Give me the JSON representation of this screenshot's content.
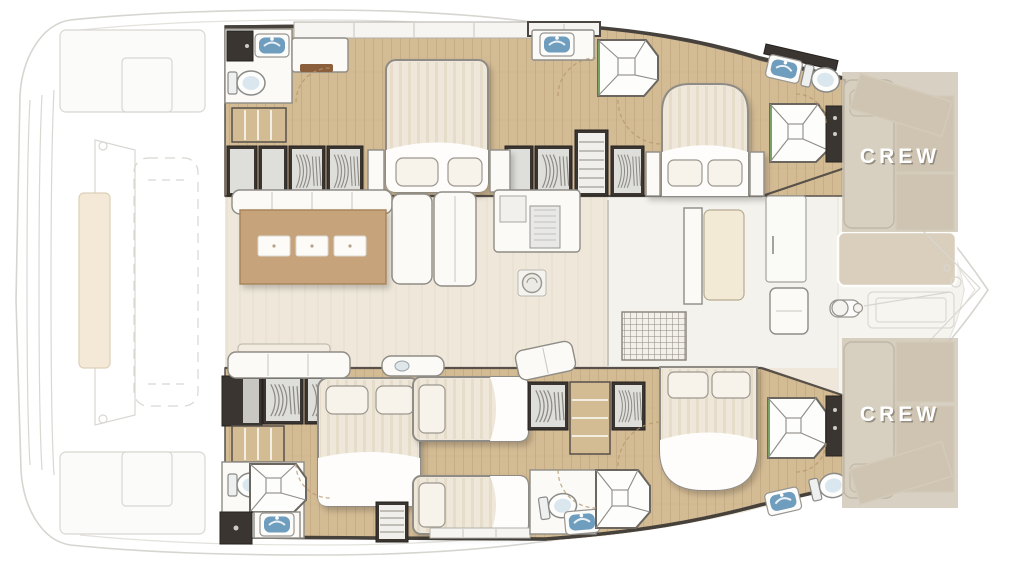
{
  "labels": {
    "crew_top": "CREW",
    "crew_bottom": "CREW"
  },
  "colors": {
    "page_bg": "#ffffff",
    "hull_line": "#d7d5d0",
    "deck": "#efe8da",
    "wood": "#d3bb94",
    "wood_grain": "#a98f66",
    "dark_strip": "#46413b",
    "wall_dark": "#57514a",
    "dark_cabinet": "#3a3531",
    "furniture_white": "#fbfaf7",
    "furniture_stroke": "#8f8c86",
    "mattress": "#efe8da",
    "pillow": "#f7f3ea",
    "table_wood": "#c7a37c",
    "sunpad": "#d9cfbc",
    "crew_overlay": "#cdc3b1",
    "crew_text": "#ffffff",
    "crew_text_shadow": "#8a8478",
    "sink_blue": "#6f9dbd",
    "shower_accent_green": "#79a065",
    "door_arc": "#b5956b",
    "stern_pad": "#f4e9d6"
  },
  "legend": {
    "areas": [
      "aft-deck",
      "salon",
      "galley",
      "forward-cockpit",
      "bow-sunpad",
      "crew-quarters-top",
      "crew-quarters-bottom",
      "top-hull-cabins",
      "bottom-hull-cabins"
    ],
    "fixtures": [
      "double-bed",
      "single-berth",
      "crew-berth",
      "pillow",
      "wardrobe",
      "shelf-unit",
      "staircase",
      "toilet",
      "sink",
      "shower",
      "locker",
      "salon-table",
      "placemat",
      "sofa",
      "galley-counter",
      "floor-hatch",
      "deck-hatch",
      "cockpit-bench",
      "coffee-table",
      "door",
      "windlass",
      "tender-platform"
    ]
  }
}
